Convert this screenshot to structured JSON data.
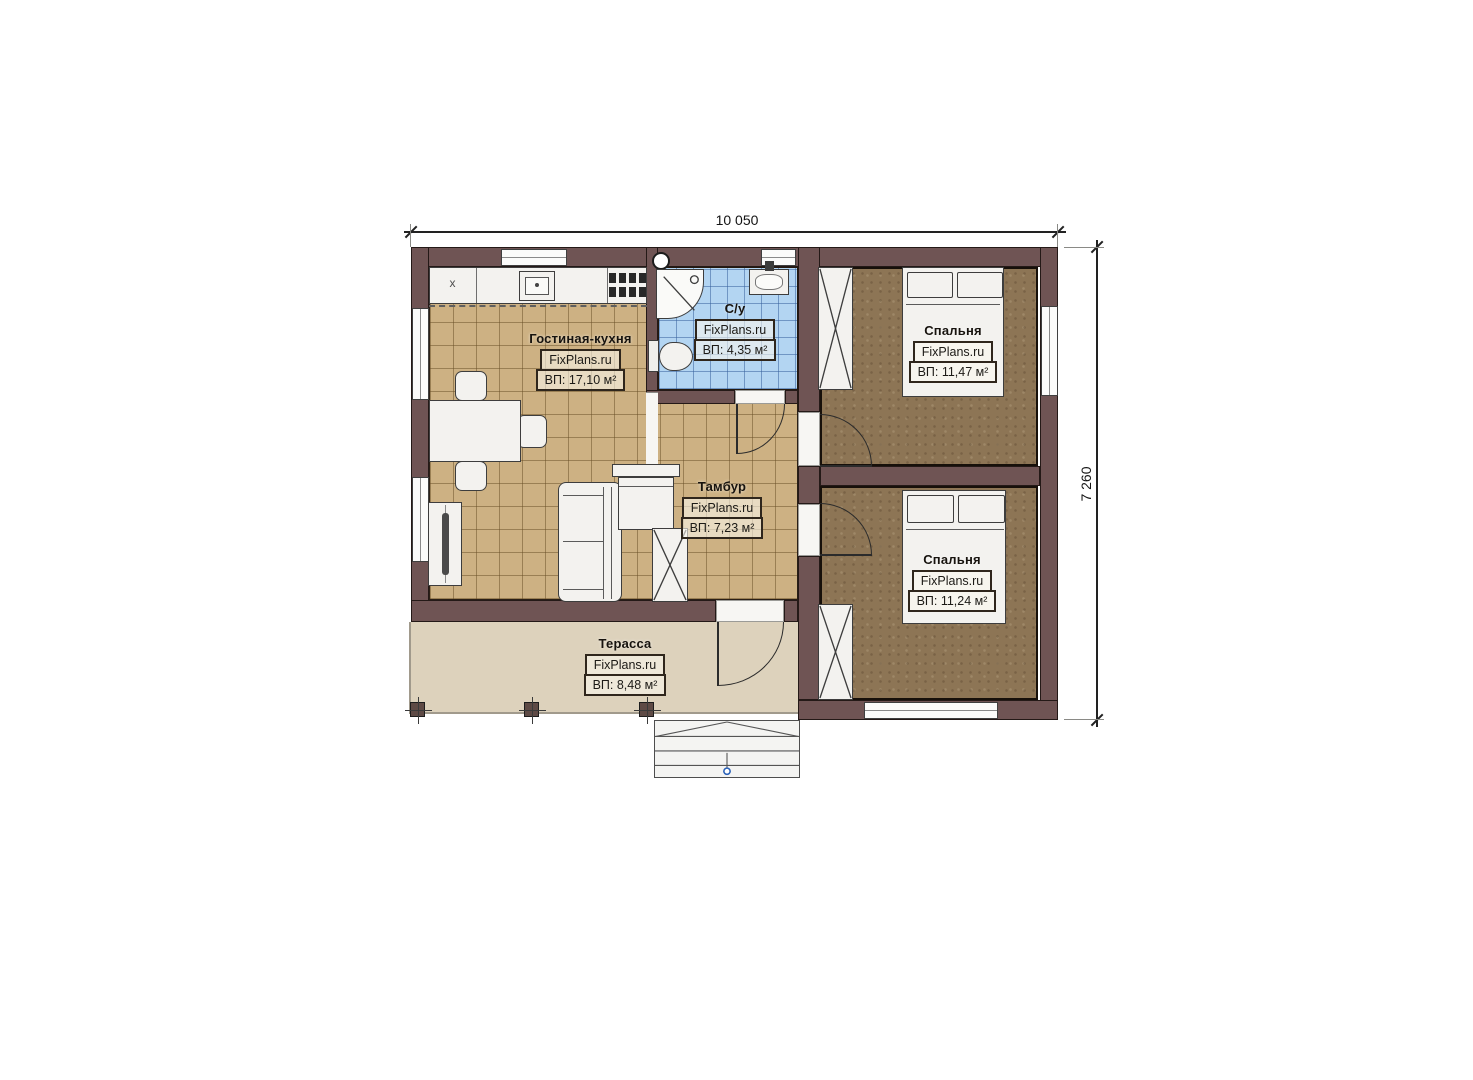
{
  "plan": {
    "dimensions": {
      "width_label": "10 050",
      "height_label": "7 260"
    },
    "rooms": [
      {
        "id": "living-kitchen",
        "name": "Гостиная-кухня",
        "watermark": "FixPlans.ru",
        "area": "ВП: 17,10 м²"
      },
      {
        "id": "bathroom",
        "name": "С/у",
        "watermark": "FixPlans.ru",
        "area": "ВП: 4,35 м²"
      },
      {
        "id": "bedroom-top",
        "name": "Спальня",
        "watermark": "FixPlans.ru",
        "area": "ВП: 11,47 м²"
      },
      {
        "id": "vestibule",
        "name": "Тамбур",
        "watermark": "FixPlans.ru",
        "area": "ВП: 7,23 м²"
      },
      {
        "id": "bedroom-bottom",
        "name": "Спальня",
        "watermark": "FixPlans.ru",
        "area": "ВП: 11,24 м²"
      },
      {
        "id": "terrace",
        "name": "Терасса",
        "watermark": "FixPlans.ru",
        "area": "ВП: 8,48 м²"
      }
    ],
    "kitchen_marker": "x",
    "colors": {
      "wall": "#6f5454",
      "floor_tile": "#cdb183",
      "floor_bath": "#b3d5f2",
      "floor_bedroom": "#8d7555",
      "floor_terrace": "#ddd2bc",
      "outline_box": "#2f261c",
      "accent_blue": "#2b62b8"
    }
  }
}
